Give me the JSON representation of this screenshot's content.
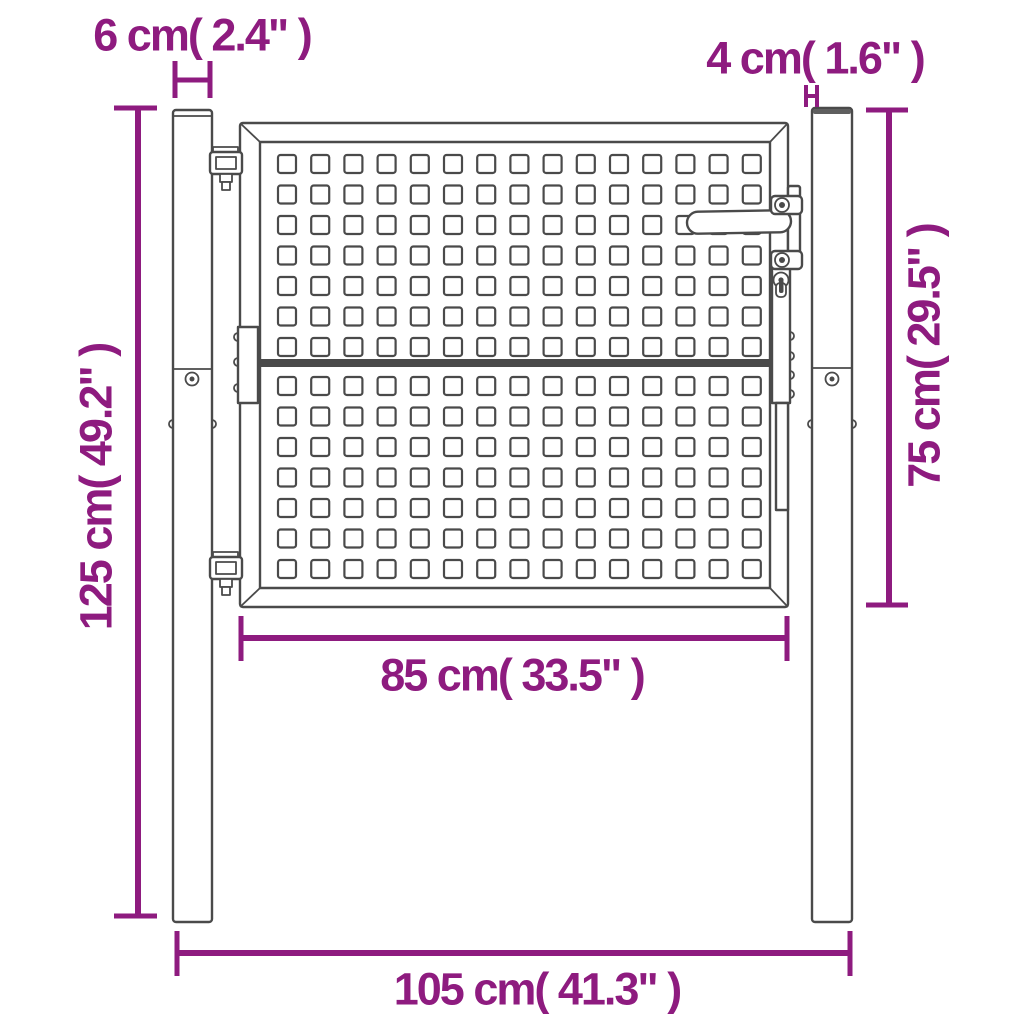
{
  "diagram": {
    "title": "Garden gate dimension drawing",
    "labels": {
      "post_width": "6 cm( 2.4\" )",
      "gap_width": "4 cm( 1.6\" )",
      "post_height": "125 cm( 49.2\" )",
      "gate_height": "75 cm( 29.5\" )",
      "gate_width": "85 cm( 33.5\" )",
      "total_width": "105 cm( 41.3\" )"
    },
    "colors": {
      "dimension": "#8E1B7F",
      "line": "#4A4A4A",
      "background": "#FFFFFF"
    }
  }
}
